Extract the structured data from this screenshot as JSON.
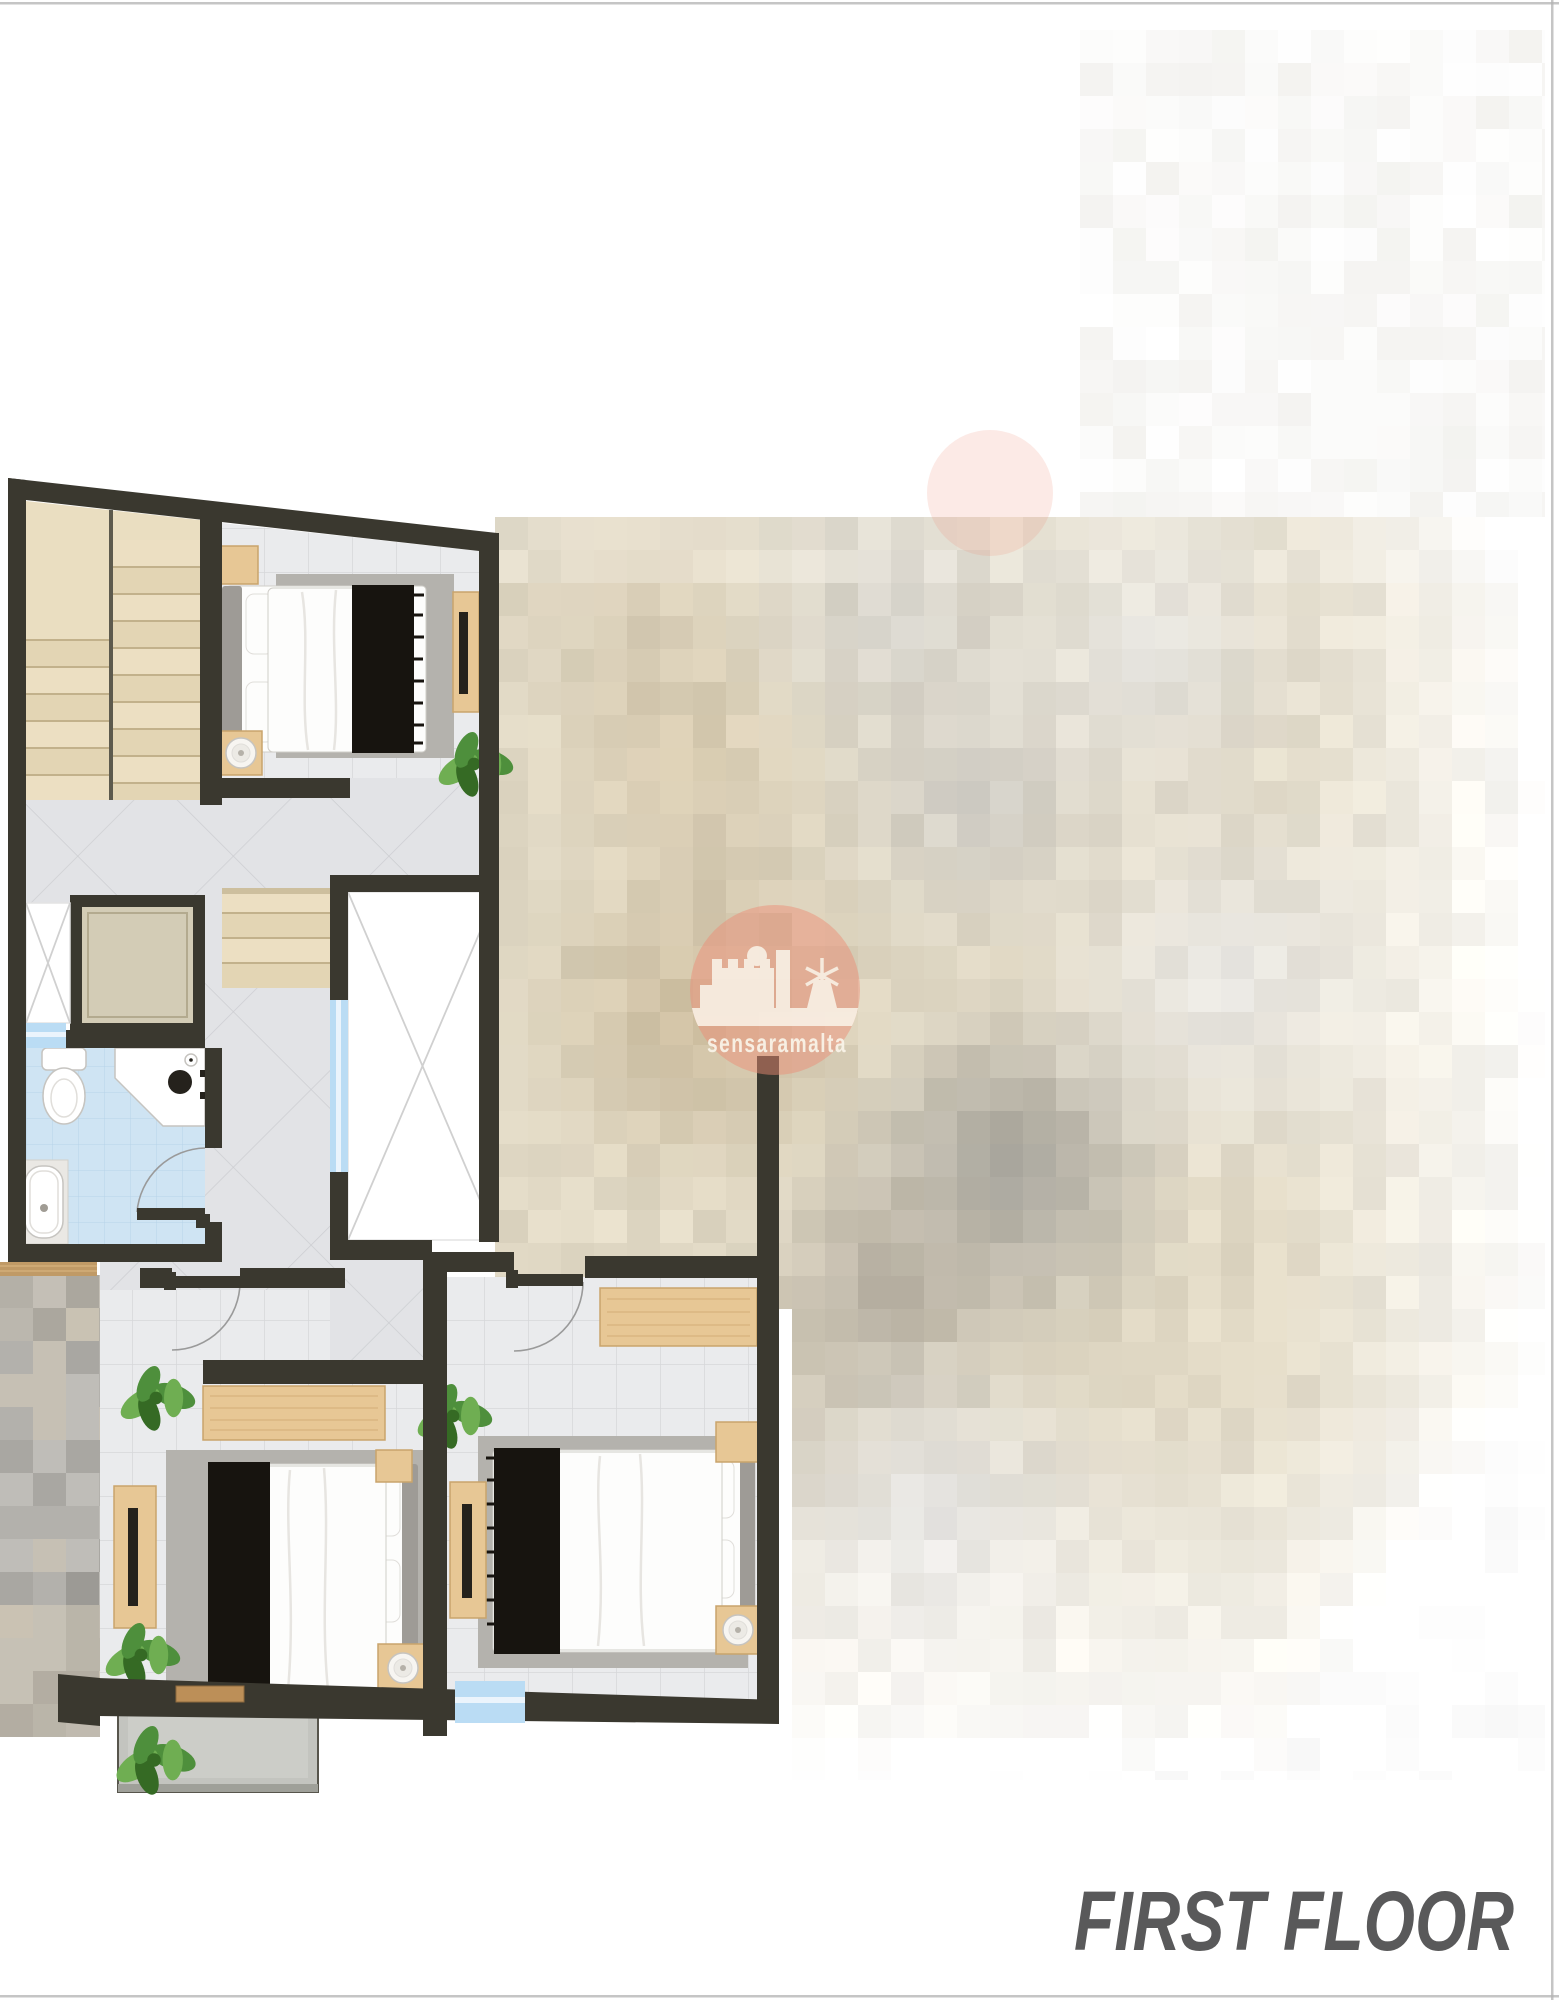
{
  "watermark": {
    "brand": "sensaramalta"
  },
  "footer": {
    "title": "FIRST FLOOR"
  },
  "colors": {
    "white": "#ffffff",
    "wall": "#3a382f",
    "border": "#b2b2b2",
    "label": "#59595a",
    "tile": "#eaebed",
    "grout": "#d6d7da",
    "diag": "#e2e3e6",
    "diagGrout": "#cccdd1",
    "bath": "#cfe4f3",
    "bathGrout": "#b7d3e8",
    "stair": "#ecdfc2",
    "stairAlt": "#e3d5b4",
    "stairEdge": "#c2b18b",
    "stairSlab": "#eadec1",
    "cab": "#d3ccb6",
    "cabLine": "#b3aa8f",
    "wood": "#e7c795",
    "woodEdge": "#c9a46c",
    "woodGrain": "#d7b27e",
    "glass": "#badcf4",
    "glassLite": "#ebf4fc",
    "voidX": "#d0d0d0",
    "voidBorder": "#e3e3e3",
    "rug": "#b4b2ad",
    "bedWhite": "#fdfdfc",
    "bedStroke": "#d0cec9",
    "fold": "#e7e5e1",
    "headboard": "#9e9b96",
    "cushion": "#a9a6a1",
    "cushionDark": "#8b8883",
    "throw": "#17140f",
    "plantA": "#4e8f3c",
    "plantB": "#6fae52",
    "plantC": "#356a24",
    "balconyFloor": "#c3c4bf",
    "balconyInner": "#cccdc8",
    "balconyLine": "#57554c",
    "parapet": "#9fa099",
    "thresholdWood": "#bc8f58",
    "thresholdEdge": "#8d6a3e",
    "marble": "#eae8e4",
    "fixture": "#c6c4c0",
    "fixtureLite": "#e0deda",
    "dark": "#25221c",
    "arc": "#9a9a9a",
    "wmPink": "#ec8d76",
    "wmWhite": "#faf5ea",
    "mosaicWoodSliver": "#c09a66",
    "dishA": "#f7f5f1",
    "dishB": "#eceae5",
    "dishC": "#b5b1a9"
  },
  "blur": {
    "block": 33,
    "regionA": {
      "x0": 495,
      "x1": 1545,
      "y0": 517,
      "y1": 1780,
      "innerX": 779,
      "innerY": 1277
    },
    "base": "#e0d8c4",
    "blobs": [
      [
        640,
        600,
        150,
        "#d8cdb6"
      ],
      [
        680,
        760,
        160,
        "#d5c8ad"
      ],
      [
        700,
        1010,
        200,
        "#cbbc9e"
      ],
      [
        900,
        620,
        180,
        "#d6d3cb"
      ],
      [
        980,
        800,
        170,
        "#d0cdc5"
      ],
      [
        1010,
        1170,
        190,
        "#a8a59c"
      ],
      [
        880,
        1300,
        160,
        "#b7b0a2"
      ],
      [
        1150,
        650,
        200,
        "#e4e2dc"
      ],
      [
        1230,
        980,
        220,
        "#e7e5e0"
      ],
      [
        930,
        1520,
        200,
        "#d8d6d1"
      ],
      [
        760,
        1430,
        150,
        "#c9c2b2"
      ]
    ],
    "fadeRight": {
      "start": 1260,
      "len": 270
    },
    "fadeBottom": {
      "start": 1370,
      "len": 390
    },
    "regionB": {
      "x0": 0,
      "x1": 100,
      "y0": 1275,
      "y1": 1737,
      "palette": [
        "#b3b1ac",
        "#a9a7a2",
        "#bfbdb8",
        "#9c9a95",
        "#c6c0b4"
      ],
      "beige": "#cfc5b2"
    },
    "regionTR": {
      "x0": 1080,
      "x1": 1545,
      "y0": 30,
      "y1": 517,
      "tint": "#f2f1ee"
    }
  }
}
